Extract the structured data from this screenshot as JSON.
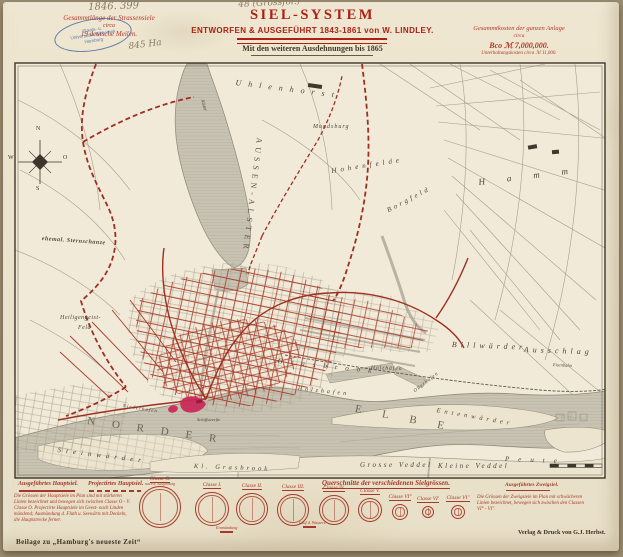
{
  "colors": {
    "accent_red": "#a93226",
    "title_red": "#ad2014",
    "water_gray": "#c8c3b3",
    "ink": "#4c463b",
    "pencil": "#8a7b63",
    "stamp_blue": "#4a69a4",
    "highlight_carmine": "#c92757"
  },
  "header": {
    "left_note": {
      "line1": "Gesammtlänge der Strassensiele",
      "line2": "circa",
      "line3": "19 deutsche Meilen."
    },
    "right_note": {
      "line1": "Gesammtkosten der ganzen Anlage",
      "line2": "circa",
      "line3": "Bco ℳ 7,000,000.",
      "line4": "Unterhaltungskosten circa ℳ 11,000."
    },
    "title": "SIEL-SYSTEM",
    "subtitle": "ENTWORFEN & AUSGEFÜHRT 1843-1861 von W. LINDLEY.",
    "dedication": "Mit den weiteren Ausdehnungen bis 1865",
    "pencil_number": "1846. 399",
    "pencil_format": "48 (Grossfol.)",
    "pencil_area": "845 Ha",
    "stamp": {
      "line1": "Staats- u.",
      "line2": "Universitäts-Bibliothek",
      "line3": "Hamburg"
    }
  },
  "map": {
    "labels": [
      {
        "t": "AUSSEN-ALSTER",
        "x": 263,
        "y": 138,
        "r": 97,
        "ls": 4,
        "fs": 8,
        "c": "#5a5448",
        "up": 1
      },
      {
        "t": "Alster",
        "x": 204,
        "y": 99,
        "r": 75,
        "fs": 5
      },
      {
        "t": "Uhlenhorst",
        "x": 236,
        "y": 79,
        "r": 7,
        "ls": 7,
        "fs": 8
      },
      {
        "t": "Mundsburg",
        "x": 313,
        "y": 124,
        "ls": 1,
        "fs": 6
      },
      {
        "t": "Hohenfelde",
        "x": 331,
        "y": 168,
        "r": -9,
        "ls": 4,
        "fs": 7
      },
      {
        "t": "Borgfeld",
        "x": 386,
        "y": 208,
        "r": -28,
        "ls": 3,
        "fs": 7
      },
      {
        "t": "Hamm",
        "x": 478,
        "y": 178,
        "r": -7,
        "ls": 22,
        "fs": 9
      },
      {
        "t": "ehemal. Sternschanze",
        "x": 42,
        "y": 236,
        "r": 4,
        "ls": 0.5,
        "fs": 6,
        "b": 1
      },
      {
        "t": "Heiligengeist-",
        "x": 60,
        "y": 315,
        "fs": 6,
        "ls": 0.5
      },
      {
        "t": "Feld",
        "x": 78,
        "y": 325,
        "fs": 6,
        "ls": 0.5
      },
      {
        "t": "Billwärder",
        "x": 452,
        "y": 341,
        "r": 2,
        "ls": 4,
        "fs": 8
      },
      {
        "t": "Ausschlag",
        "x": 524,
        "y": 346,
        "r": 2,
        "ls": 4,
        "fs": 8
      },
      {
        "t": "Eisenbahn",
        "x": 553,
        "y": 363,
        "r": 3,
        "fs": 4.5
      },
      {
        "t": "Entenwärder",
        "x": 437,
        "y": 408,
        "r": 10,
        "ls": 4,
        "fs": 6.5
      },
      {
        "t": "Steinwärder",
        "x": 58,
        "y": 447,
        "r": 7,
        "ls": 5,
        "fs": 7
      },
      {
        "t": "NORDER",
        "x": 88,
        "y": 416,
        "r": 8,
        "ls": 17,
        "fs": 11,
        "c": "#6a6354",
        "up": 1
      },
      {
        "t": "ELBE",
        "x": 356,
        "y": 404,
        "r": 11,
        "ls": 21,
        "fs": 11,
        "c": "#6a6354",
        "up": 1
      },
      {
        "t": "Grosse Veddel",
        "x": 360,
        "y": 462,
        "ls": 2.5,
        "fs": 7
      },
      {
        "t": "Kleine Veddel",
        "x": 438,
        "y": 463,
        "ls": 2.5,
        "fs": 7
      },
      {
        "t": "Peute",
        "x": 505,
        "y": 456,
        "r": 2,
        "ls": 9,
        "fs": 7
      },
      {
        "t": "Kl. Grasbrook",
        "x": 194,
        "y": 464,
        "r": 2,
        "ls": 3,
        "fs": 6.5
      },
      {
        "t": "Niederhafen",
        "x": 123,
        "y": 404,
        "r": 9,
        "fs": 5,
        "ls": 1
      },
      {
        "t": "Schiffswerfte",
        "x": 197,
        "y": 418,
        "fs": 4.5
      },
      {
        "t": "Grasbrook",
        "x": 278,
        "y": 358,
        "r": 6,
        "ls": 8,
        "fs": 7
      },
      {
        "t": "Holzhafen",
        "x": 298,
        "y": 386,
        "r": 6,
        "ls": 3,
        "fs": 6
      },
      {
        "t": "Holzhäfen",
        "x": 371,
        "y": 366,
        "r": 2,
        "fs": 5.5,
        "ls": 1
      },
      {
        "t": "Oberhafen",
        "x": 413,
        "y": 390,
        "r": -38,
        "fs": 5,
        "ls": 1
      },
      {
        "t": "N",
        "x": 36,
        "y": 126,
        "fs": 6,
        "up": 1,
        "c": "#3c362c"
      },
      {
        "t": "O",
        "x": 63,
        "y": 155,
        "fs": 6,
        "up": 1,
        "c": "#3c362c"
      },
      {
        "t": "S",
        "x": 36,
        "y": 186,
        "fs": 6,
        "up": 1,
        "c": "#3c362c"
      },
      {
        "t": "W",
        "x": 8,
        "y": 155,
        "fs": 6,
        "up": 1,
        "c": "#3c362c"
      }
    ]
  },
  "legend": {
    "executed": "Ausgeführtes Hauptsiel.",
    "projected": "Projectirtes Hauptsiel.",
    "branch": "Ausgeführtes Zweigsiel.",
    "heading": "Querschnitte der verschiedenen Sielgrössen.",
    "note_left": [
      "Die Grössen der Hauptsiele im Plan sind mit stärkeren",
      "Linien bezeichnet und bewegen sich zwischen Classe O - V.",
      "Classe O. Projectirte Hauptsiele im Geest- nach Linden",
      "mündend; Ausmündung d. Fluth u. Seewärts mit Deckeln,",
      "die Hauptstrecke ferner."
    ],
    "note_right": [
      "Die Grössen der Zweigsiele im Plan mit schwächeren",
      "Linien bezeichnet, bewegen sich zwischen den Classen",
      "VI° - VI''."
    ],
    "classes": [
      {
        "label": "Classe O.",
        "sub": "nach d. Ausführung",
        "x": 160,
        "y": 507,
        "r": 21
      },
      {
        "label": "Classe I.",
        "x": 212,
        "y": 509,
        "r": 17
      },
      {
        "label": "Classe II.",
        "x": 252,
        "y": 509,
        "r": 16
      },
      {
        "label": "Classe III.",
        "x": 293,
        "y": 510,
        "r": 16
      },
      {
        "label": "Classe IV.",
        "x": 334,
        "y": 510,
        "r": 15
      },
      {
        "label": "Classe V.",
        "x": 370,
        "y": 510,
        "r": 12
      },
      {
        "label": "Classe VI°",
        "x": 400,
        "y": 512,
        "r": 8
      },
      {
        "label": "Classe VI'",
        "x": 428,
        "y": 512,
        "r": 6
      },
      {
        "label": "Classe VI''",
        "x": 458,
        "y": 512,
        "r": 7
      }
    ],
    "annotations": [
      {
        "text": "Einmündung",
        "x": 216,
        "y": 525
      },
      {
        "text": "Lauf d. Wassers",
        "x": 299,
        "y": 520
      }
    ]
  },
  "footer": {
    "left": "Beilage zu „Hamburg's neueste Zeit“",
    "right": "Verlag & Druck von G.J. Herbst."
  }
}
